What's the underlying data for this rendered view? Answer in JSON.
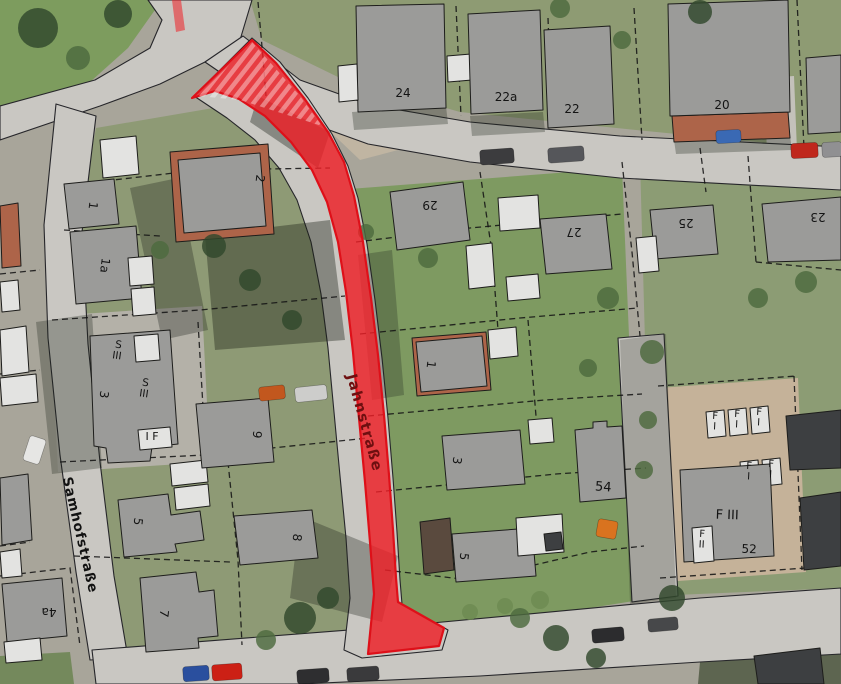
{
  "map": {
    "width": 841,
    "height": 684,
    "highlighted_street_name": "Jahnstraße",
    "secondary_street_name": "Samhofstraße",
    "palette": {
      "base": "#a8a59a",
      "street": "#c9c7c2",
      "street_edge": "#26262a",
      "parcel_line": "#141414",
      "building_gray": "#9b9b99",
      "building_light": "#e3e3e1",
      "building_dark": "#3d3f41",
      "roof_tile": "#ad6449",
      "roof_brown": "#5a4a3e",
      "highlight_red": "#ee1f26",
      "highlight_stroke": "#de1019",
      "label_red": "#6e0f10",
      "label_black": "#141414",
      "tree_dark": "#31482c",
      "tree_mid": "#4d6a3e",
      "tree_bush": "#6d8a52"
    },
    "greens": [
      {
        "points": "0,0 162,0 128,48 70,100 0,132",
        "fill": "#7d9c5e"
      },
      {
        "points": "250,0 841,0 841,148 798,146 636,130 460,112 340,78 262,40",
        "fill": "#8e9b73"
      },
      {
        "points": "96,128 260,100 332,180 372,360 392,560 400,648 118,656 62,310",
        "fill": "#8e9a75"
      },
      {
        "points": "336,190 622,168 640,600 402,638 380,420",
        "fill": "#7e9a61"
      },
      {
        "points": "640,160 841,152 841,588 652,596",
        "fill": "#8c9c74"
      },
      {
        "points": "0,656 70,652 74,684 0,684",
        "fill": "#74895c"
      },
      {
        "points": "700,662 841,652 841,684 698,684",
        "fill": "#5d6550"
      }
    ],
    "pavements": [
      {
        "points": "658,388 798,378 806,572 664,582",
        "fill": "#c5b299"
      },
      {
        "points": "50,316 202,306 210,462 58,472",
        "fill": "#b4b1a8"
      },
      {
        "points": "764,78 794,76 798,176 768,178",
        "fill": "#c3c1ba"
      },
      {
        "points": "322,88 372,108 398,150 360,160 318,120",
        "fill": "#c0b5a2"
      }
    ],
    "streets": [
      {
        "points": "148,0 252,0 240,40 205,62 160,84 100,106 0,140 0,106 95,80 150,48 162,20"
      },
      {
        "points": "243,36 300,80 370,105 470,122 620,136 841,147 841,190 620,178 470,162 368,144 296,118 240,86 205,62"
      },
      {
        "points": "56,104 44,225 48,338 60,455 76,572 90,660 128,658 114,576 100,462 88,344 82,232 96,116"
      },
      {
        "points": "92,650 400,626 700,598 841,588 841,654 700,662 480,676 300,684 96,684"
      },
      {
        "points": "618,338 664,334 678,596 632,602"
      },
      {
        "points": "194,96 252,38 280,62 308,98 332,134 348,166 358,198 367,244 375,300 382,358 388,418 393,478 397,532 400,580 402,604 448,630 442,650 362,658 344,650 350,598 346,538 340,476 334,412 328,348 321,294 311,242 297,200 279,168 255,140 227,118"
      }
    ],
    "shadows": [
      {
        "points": "130,188 178,178 208,330 162,340",
        "fill": "rgba(30,35,28,0.32)"
      },
      {
        "points": "36,322 92,314 102,468 52,474",
        "fill": "rgba(30,35,28,0.3)"
      },
      {
        "points": "300,516 398,556 382,622 290,598",
        "fill": "rgba(30,35,28,0.32)"
      },
      {
        "points": "352,112 446,106 448,124 354,130",
        "fill": "rgba(30,35,28,0.3)"
      },
      {
        "points": "470,116 543,112 545,132 472,136",
        "fill": "rgba(30,35,28,0.3)"
      },
      {
        "points": "258,96 330,132 318,168 250,122",
        "fill": "rgba(28,34,26,0.38)"
      },
      {
        "points": "358,255 392,250 404,395 372,400",
        "fill": "rgba(30,35,28,0.28)"
      },
      {
        "points": "620,340 666,334 676,598 630,604",
        "fill": "rgba(30,35,28,0.22)"
      },
      {
        "points": "674,140 790,136 792,150 676,154",
        "fill": "rgba(30,35,28,0.3)"
      },
      {
        "points": "205,235 330,220 345,340 215,350",
        "fill": "rgba(25,32,22,0.38)"
      }
    ],
    "parcel_lines": [
      "258,2 263,58 266,96",
      "456,6 461,116",
      "548,18 552,126",
      "634,8 642,140",
      "797,0 804,148",
      "700,148 706,192",
      "480,172 492,252 498,330",
      "622,162 632,252 640,336",
      "748,156 756,262",
      "756,262 841,270",
      "356,242 470,228 622,214",
      "360,334 520,318 638,308",
      "368,416 545,400 642,394",
      "376,492 556,474 646,468",
      "385,570 470,580 590,552 644,546",
      "96,182 200,170 330,168",
      "64,230 160,236",
      "52,320 200,310 345,296",
      "60,462 205,455 368,438",
      "74,556 230,562",
      "0,576 70,568 80,646",
      "198,322 206,458",
      "228,462 238,560 242,645",
      "658,386 796,376",
      "660,578 806,568",
      "794,376 802,570",
      "528,320 536,416",
      "0,274 40,270",
      "0,374 40,370",
      "0,546 30,542"
    ],
    "buildings": [
      {
        "points": "672,116 788,112 790,138 674,142",
        "kind": "r"
      },
      {
        "points": "170,152 268,144 274,234 176,242",
        "kind": "r"
      },
      {
        "points": "412,338 486,332 491,390 417,396",
        "kind": "r"
      },
      {
        "points": "0,206 18,203 21,266 2,268",
        "kind": "r"
      },
      {
        "points": "420,522 450,518 454,570 424,574",
        "kind": "b"
      },
      {
        "points": "356,6 444,4 446,108 358,112",
        "kind": "g"
      },
      {
        "points": "338,66 357,64 358,100 339,102",
        "kind": "w"
      },
      {
        "points": "447,56 471,54 472,80 448,82",
        "kind": "w"
      },
      {
        "points": "468,14 540,10 543,110 471,114",
        "kind": "g"
      },
      {
        "points": "544,30 610,26 614,124 548,128",
        "kind": "g"
      },
      {
        "points": "668,4 788,0 790,112 670,116",
        "kind": "g"
      },
      {
        "points": "806,58 841,55 841,132 808,134",
        "kind": "g"
      },
      {
        "points": "390,192 463,182 470,240 397,250",
        "kind": "g"
      },
      {
        "points": "466,246 492,243 495,286 469,289",
        "kind": "w"
      },
      {
        "points": "498,198 538,195 540,228 500,231",
        "kind": "w"
      },
      {
        "points": "540,219 606,214 612,269 546,274",
        "kind": "g"
      },
      {
        "points": "506,277 538,274 540,298 508,301",
        "kind": "w"
      },
      {
        "points": "650,210 713,205 718,254 655,259",
        "kind": "g"
      },
      {
        "points": "636,238 656,236 659,271 639,273",
        "kind": "w"
      },
      {
        "points": "762,204 841,197 841,260 768,262",
        "kind": "g"
      },
      {
        "points": "178,160 260,153 266,226 184,233",
        "kind": "g"
      },
      {
        "points": "100,140 136,136 139,174 103,178",
        "kind": "w"
      },
      {
        "points": "64,184 114,179 119,224 69,229",
        "kind": "g"
      },
      {
        "points": "70,232 136,226 142,298 76,304",
        "kind": "g"
      },
      {
        "points": "128,258 152,256 154,284 130,286",
        "kind": "w"
      },
      {
        "points": "131,289 154,287 156,314 133,316",
        "kind": "w"
      },
      {
        "points": "90,336 170,330 178,444 152,447 150,461 108,463 106,448 94,446",
        "kind": "g"
      },
      {
        "points": "134,336 158,334 160,360 136,362",
        "kind": "w"
      },
      {
        "points": "138,430 170,427 172,447 140,450",
        "kind": "w"
      },
      {
        "points": "118,500 168,494 171,515 200,511 204,540 175,544 177,552 124,557",
        "kind": "g"
      },
      {
        "points": "170,464 206,460 208,482 172,486",
        "kind": "w"
      },
      {
        "points": "174,488 208,484 210,506 176,510",
        "kind": "w"
      },
      {
        "points": "140,578 196,572 199,592 214,590 218,636 198,638 199,648 146,652",
        "kind": "g"
      },
      {
        "points": "2,584 62,578 67,636 7,642",
        "kind": "g"
      },
      {
        "points": "4,642 40,638 42,660 6,663",
        "kind": "w"
      },
      {
        "points": "196,404 268,398 274,462 202,468",
        "kind": "g"
      },
      {
        "points": "234,516 312,510 318,558 240,565",
        "kind": "g"
      },
      {
        "points": "0,282 18,280 20,310 2,312",
        "kind": "w"
      },
      {
        "points": "0,330 26,326 29,372 2,376",
        "kind": "w"
      },
      {
        "points": "0,378 36,374 38,402 2,406",
        "kind": "w"
      },
      {
        "points": "0,478 28,474 32,540 2,545",
        "kind": "g"
      },
      {
        "points": "0,552 20,549 22,576 2,578",
        "kind": "w"
      },
      {
        "points": "416,342 482,336 487,386 421,392",
        "kind": "g"
      },
      {
        "points": "488,330 516,327 518,356 490,359",
        "kind": "w"
      },
      {
        "points": "442,436 520,430 525,484 447,490",
        "kind": "g"
      },
      {
        "points": "528,420 552,418 554,442 530,444",
        "kind": "w"
      },
      {
        "points": "452,534 532,528 536,576 456,582",
        "kind": "g"
      },
      {
        "points": "516,518 562,514 564,552 518,556",
        "kind": "w"
      },
      {
        "points": "544,534 561,532 563,549 546,551",
        "kind": "d"
      },
      {
        "points": "575,430 593,428 593,422 607,421 607,427 622,426 626,498 580,502",
        "kind": "g"
      },
      {
        "points": "706,412 724,410 726,436 708,438",
        "kind": "w"
      },
      {
        "points": "728,410 746,408 748,434 730,436",
        "kind": "w"
      },
      {
        "points": "750,408 768,406 770,432 752,434",
        "kind": "w"
      },
      {
        "points": "740,462 758,460 760,486 742,488",
        "kind": "w"
      },
      {
        "points": "762,460 780,458 782,484 764,486",
        "kind": "w"
      },
      {
        "points": "680,470 770,464 774,556 684,562",
        "kind": "g"
      },
      {
        "points": "692,528 712,526 714,561 694,563",
        "kind": "w"
      },
      {
        "points": "786,416 841,410 841,468 790,470",
        "kind": "d"
      },
      {
        "points": "800,498 841,492 841,566 804,570",
        "kind": "d"
      },
      {
        "points": "754,656 820,648 824,684 758,684",
        "kind": "d"
      }
    ],
    "trees": [
      {
        "x": 38,
        "y": 28,
        "r": 20,
        "tone": "dark"
      },
      {
        "x": 118,
        "y": 14,
        "r": 14,
        "tone": "dark"
      },
      {
        "x": 78,
        "y": 58,
        "r": 12,
        "tone": "mid"
      },
      {
        "x": 300,
        "y": 618,
        "r": 16,
        "tone": "dark"
      },
      {
        "x": 328,
        "y": 598,
        "r": 11,
        "tone": "dark"
      },
      {
        "x": 266,
        "y": 640,
        "r": 10,
        "tone": "mid"
      },
      {
        "x": 520,
        "y": 618,
        "r": 10,
        "tone": "mid"
      },
      {
        "x": 556,
        "y": 638,
        "r": 13,
        "tone": "dark"
      },
      {
        "x": 596,
        "y": 658,
        "r": 10,
        "tone": "dark"
      },
      {
        "x": 652,
        "y": 352,
        "r": 12,
        "tone": "mid"
      },
      {
        "x": 648,
        "y": 420,
        "r": 9,
        "tone": "mid"
      },
      {
        "x": 644,
        "y": 470,
        "r": 9,
        "tone": "mid"
      },
      {
        "x": 672,
        "y": 598,
        "r": 13,
        "tone": "dark"
      },
      {
        "x": 428,
        "y": 258,
        "r": 10,
        "tone": "mid"
      },
      {
        "x": 366,
        "y": 232,
        "r": 8,
        "tone": "mid"
      },
      {
        "x": 608,
        "y": 298,
        "r": 11,
        "tone": "mid"
      },
      {
        "x": 588,
        "y": 368,
        "r": 9,
        "tone": "mid"
      },
      {
        "x": 758,
        "y": 298,
        "r": 10,
        "tone": "mid"
      },
      {
        "x": 806,
        "y": 282,
        "r": 11,
        "tone": "mid"
      },
      {
        "x": 700,
        "y": 12,
        "r": 12,
        "tone": "dark"
      },
      {
        "x": 560,
        "y": 8,
        "r": 10,
        "tone": "mid"
      },
      {
        "x": 622,
        "y": 40,
        "r": 9,
        "tone": "mid"
      },
      {
        "x": 214,
        "y": 246,
        "r": 12,
        "tone": "dark"
      },
      {
        "x": 250,
        "y": 280,
        "r": 11,
        "tone": "dark"
      },
      {
        "x": 292,
        "y": 320,
        "r": 10,
        "tone": "dark"
      },
      {
        "x": 160,
        "y": 250,
        "r": 9,
        "tone": "mid"
      },
      {
        "x": 470,
        "y": 612,
        "r": 8,
        "tone": "bush"
      },
      {
        "x": 505,
        "y": 606,
        "r": 8,
        "tone": "bush"
      },
      {
        "x": 540,
        "y": 600,
        "r": 9,
        "tone": "bush"
      }
    ],
    "cars": [
      {
        "x": 480,
        "y": 149,
        "w": 34,
        "h": 15,
        "rot": -4,
        "color": "#3c3c3e"
      },
      {
        "x": 548,
        "y": 147,
        "w": 36,
        "h": 15,
        "rot": -4,
        "color": "#55565a"
      },
      {
        "x": 791,
        "y": 143,
        "w": 27,
        "h": 15,
        "rot": -3,
        "color": "#bf271c"
      },
      {
        "x": 822,
        "y": 142,
        "w": 20,
        "h": 15,
        "rot": -3,
        "color": "#909092"
      },
      {
        "x": 716,
        "y": 130,
        "w": 25,
        "h": 13,
        "rot": -3,
        "color": "#3a69b4"
      },
      {
        "x": 183,
        "y": 666,
        "w": 26,
        "h": 15,
        "rot": -4,
        "color": "#2a4f9e"
      },
      {
        "x": 212,
        "y": 664,
        "w": 30,
        "h": 16,
        "rot": -4,
        "color": "#cc2015"
      },
      {
        "x": 297,
        "y": 669,
        "w": 32,
        "h": 14,
        "rot": -4,
        "color": "#2e2e30"
      },
      {
        "x": 347,
        "y": 667,
        "w": 32,
        "h": 14,
        "rot": -4,
        "color": "#3a3a3c"
      },
      {
        "x": 592,
        "y": 628,
        "w": 32,
        "h": 14,
        "rot": -5,
        "color": "#2c2c2e"
      },
      {
        "x": 648,
        "y": 618,
        "w": 30,
        "h": 13,
        "rot": -5,
        "color": "#47484a"
      },
      {
        "x": 26,
        "y": 437,
        "w": 17,
        "h": 26,
        "rot": 18,
        "color": "#e6e6e4"
      },
      {
        "x": 259,
        "y": 386,
        "w": 26,
        "h": 14,
        "rot": -6,
        "color": "#c2571e"
      },
      {
        "x": 295,
        "y": 386,
        "w": 32,
        "h": 15,
        "rot": -6,
        "color": "#cdcdcb"
      },
      {
        "x": 597,
        "y": 520,
        "w": 20,
        "h": 18,
        "rot": 10,
        "color": "#d9731f"
      }
    ],
    "red_overlay": {
      "main": "252,40 276,63 304,98 328,132 344,162 354,196 363,242 371,298 378,355 384,415 389,475 393,530 396,578 398,602 444,628 439,646 368,654 372,614 374,594 370,542 365,482 359,418 353,352 346,292 338,242 327,202 312,170 291,142 265,116 239,99 215,91 192,98",
      "hatch": "252,42 300,96 322,126 240,100 198,96",
      "sliver": "172,0 181,0 185,30 176,32",
      "fill_opacity": 0.82,
      "stroke_width": 2.2
    },
    "street_labels": [
      {
        "text": "Jahnstraße",
        "x": 360,
        "y": 424,
        "rot": 74.5,
        "size": 14.5,
        "color": "#6e0f10",
        "spacing": 1.2
      },
      {
        "text": "Samhofstraße",
        "x": 76,
        "y": 536,
        "rot": 77,
        "size": 13.5,
        "color": "#121212",
        "spacing": 1
      }
    ],
    "house_labels": [
      {
        "text": "24",
        "x": 403,
        "y": 97,
        "rot": 0,
        "size": 12
      },
      {
        "text": "22a",
        "x": 506,
        "y": 101,
        "rot": 0,
        "size": 12
      },
      {
        "text": "22",
        "x": 572,
        "y": 113,
        "rot": 0,
        "size": 12
      },
      {
        "text": "20",
        "x": 722,
        "y": 109,
        "rot": 0,
        "size": 12
      },
      {
        "text": "29",
        "x": 430,
        "y": 201,
        "rot": 180,
        "size": 12
      },
      {
        "text": "27",
        "x": 574,
        "y": 228,
        "rot": 180,
        "size": 12
      },
      {
        "text": "25",
        "x": 686,
        "y": 219,
        "rot": 180,
        "size": 12
      },
      {
        "text": "23",
        "x": 818,
        "y": 213,
        "rot": 180,
        "size": 12
      },
      {
        "text": "2",
        "x": 256,
        "y": 178,
        "rot": 97,
        "size": 12
      },
      {
        "text": "1",
        "x": 89,
        "y": 205,
        "rot": 97,
        "size": 12
      },
      {
        "text": "1a",
        "x": 101,
        "y": 265,
        "rot": 97,
        "size": 12
      },
      {
        "text": "3",
        "x": 100,
        "y": 394,
        "rot": 97,
        "size": 12
      },
      {
        "text": "I F",
        "x": 152,
        "y": 440,
        "rot": 0,
        "size": 11
      },
      {
        "text": "5",
        "x": 134,
        "y": 521,
        "rot": 97,
        "size": 12
      },
      {
        "text": "7",
        "x": 160,
        "y": 613,
        "rot": 97,
        "size": 12
      },
      {
        "text": "4a",
        "x": 49,
        "y": 608,
        "rot": 180,
        "size": 12
      },
      {
        "text": "9",
        "x": 253,
        "y": 434,
        "rot": 97,
        "size": 12
      },
      {
        "text": "8",
        "x": 293,
        "y": 537,
        "rot": 97,
        "size": 12
      },
      {
        "text": "1",
        "x": 427,
        "y": 364,
        "rot": 97,
        "size": 12
      },
      {
        "text": "3",
        "x": 453,
        "y": 460,
        "rot": 97,
        "size": 12
      },
      {
        "text": "5",
        "x": 460,
        "y": 556,
        "rot": 97,
        "size": 12
      },
      {
        "text": "54",
        "x": 603,
        "y": 491,
        "rot": 4,
        "size": 13
      },
      {
        "text": "F III",
        "x": 727,
        "y": 519,
        "rot": 2,
        "size": 13
      },
      {
        "text": "52",
        "x": 749,
        "y": 553,
        "rot": 2,
        "size": 12
      },
      {
        "text": "S\nIII",
        "x": 118,
        "y": 348,
        "rot": 8,
        "size": 10.5
      },
      {
        "text": "S\nIII",
        "x": 145,
        "y": 386,
        "rot": 8,
        "size": 10.5
      },
      {
        "text": "F\nI",
        "x": 715,
        "y": 419,
        "rot": 3,
        "size": 10
      },
      {
        "text": "F\nI",
        "x": 737,
        "y": 417,
        "rot": 3,
        "size": 10
      },
      {
        "text": "F\nI",
        "x": 759,
        "y": 415,
        "rot": 3,
        "size": 10
      },
      {
        "text": "F\nI",
        "x": 749,
        "y": 469,
        "rot": 3,
        "size": 10
      },
      {
        "text": "F\nI",
        "x": 771,
        "y": 467,
        "rot": 3,
        "size": 10
      },
      {
        "text": "F\nII",
        "x": 702,
        "y": 537,
        "rot": 3,
        "size": 10
      }
    ]
  }
}
